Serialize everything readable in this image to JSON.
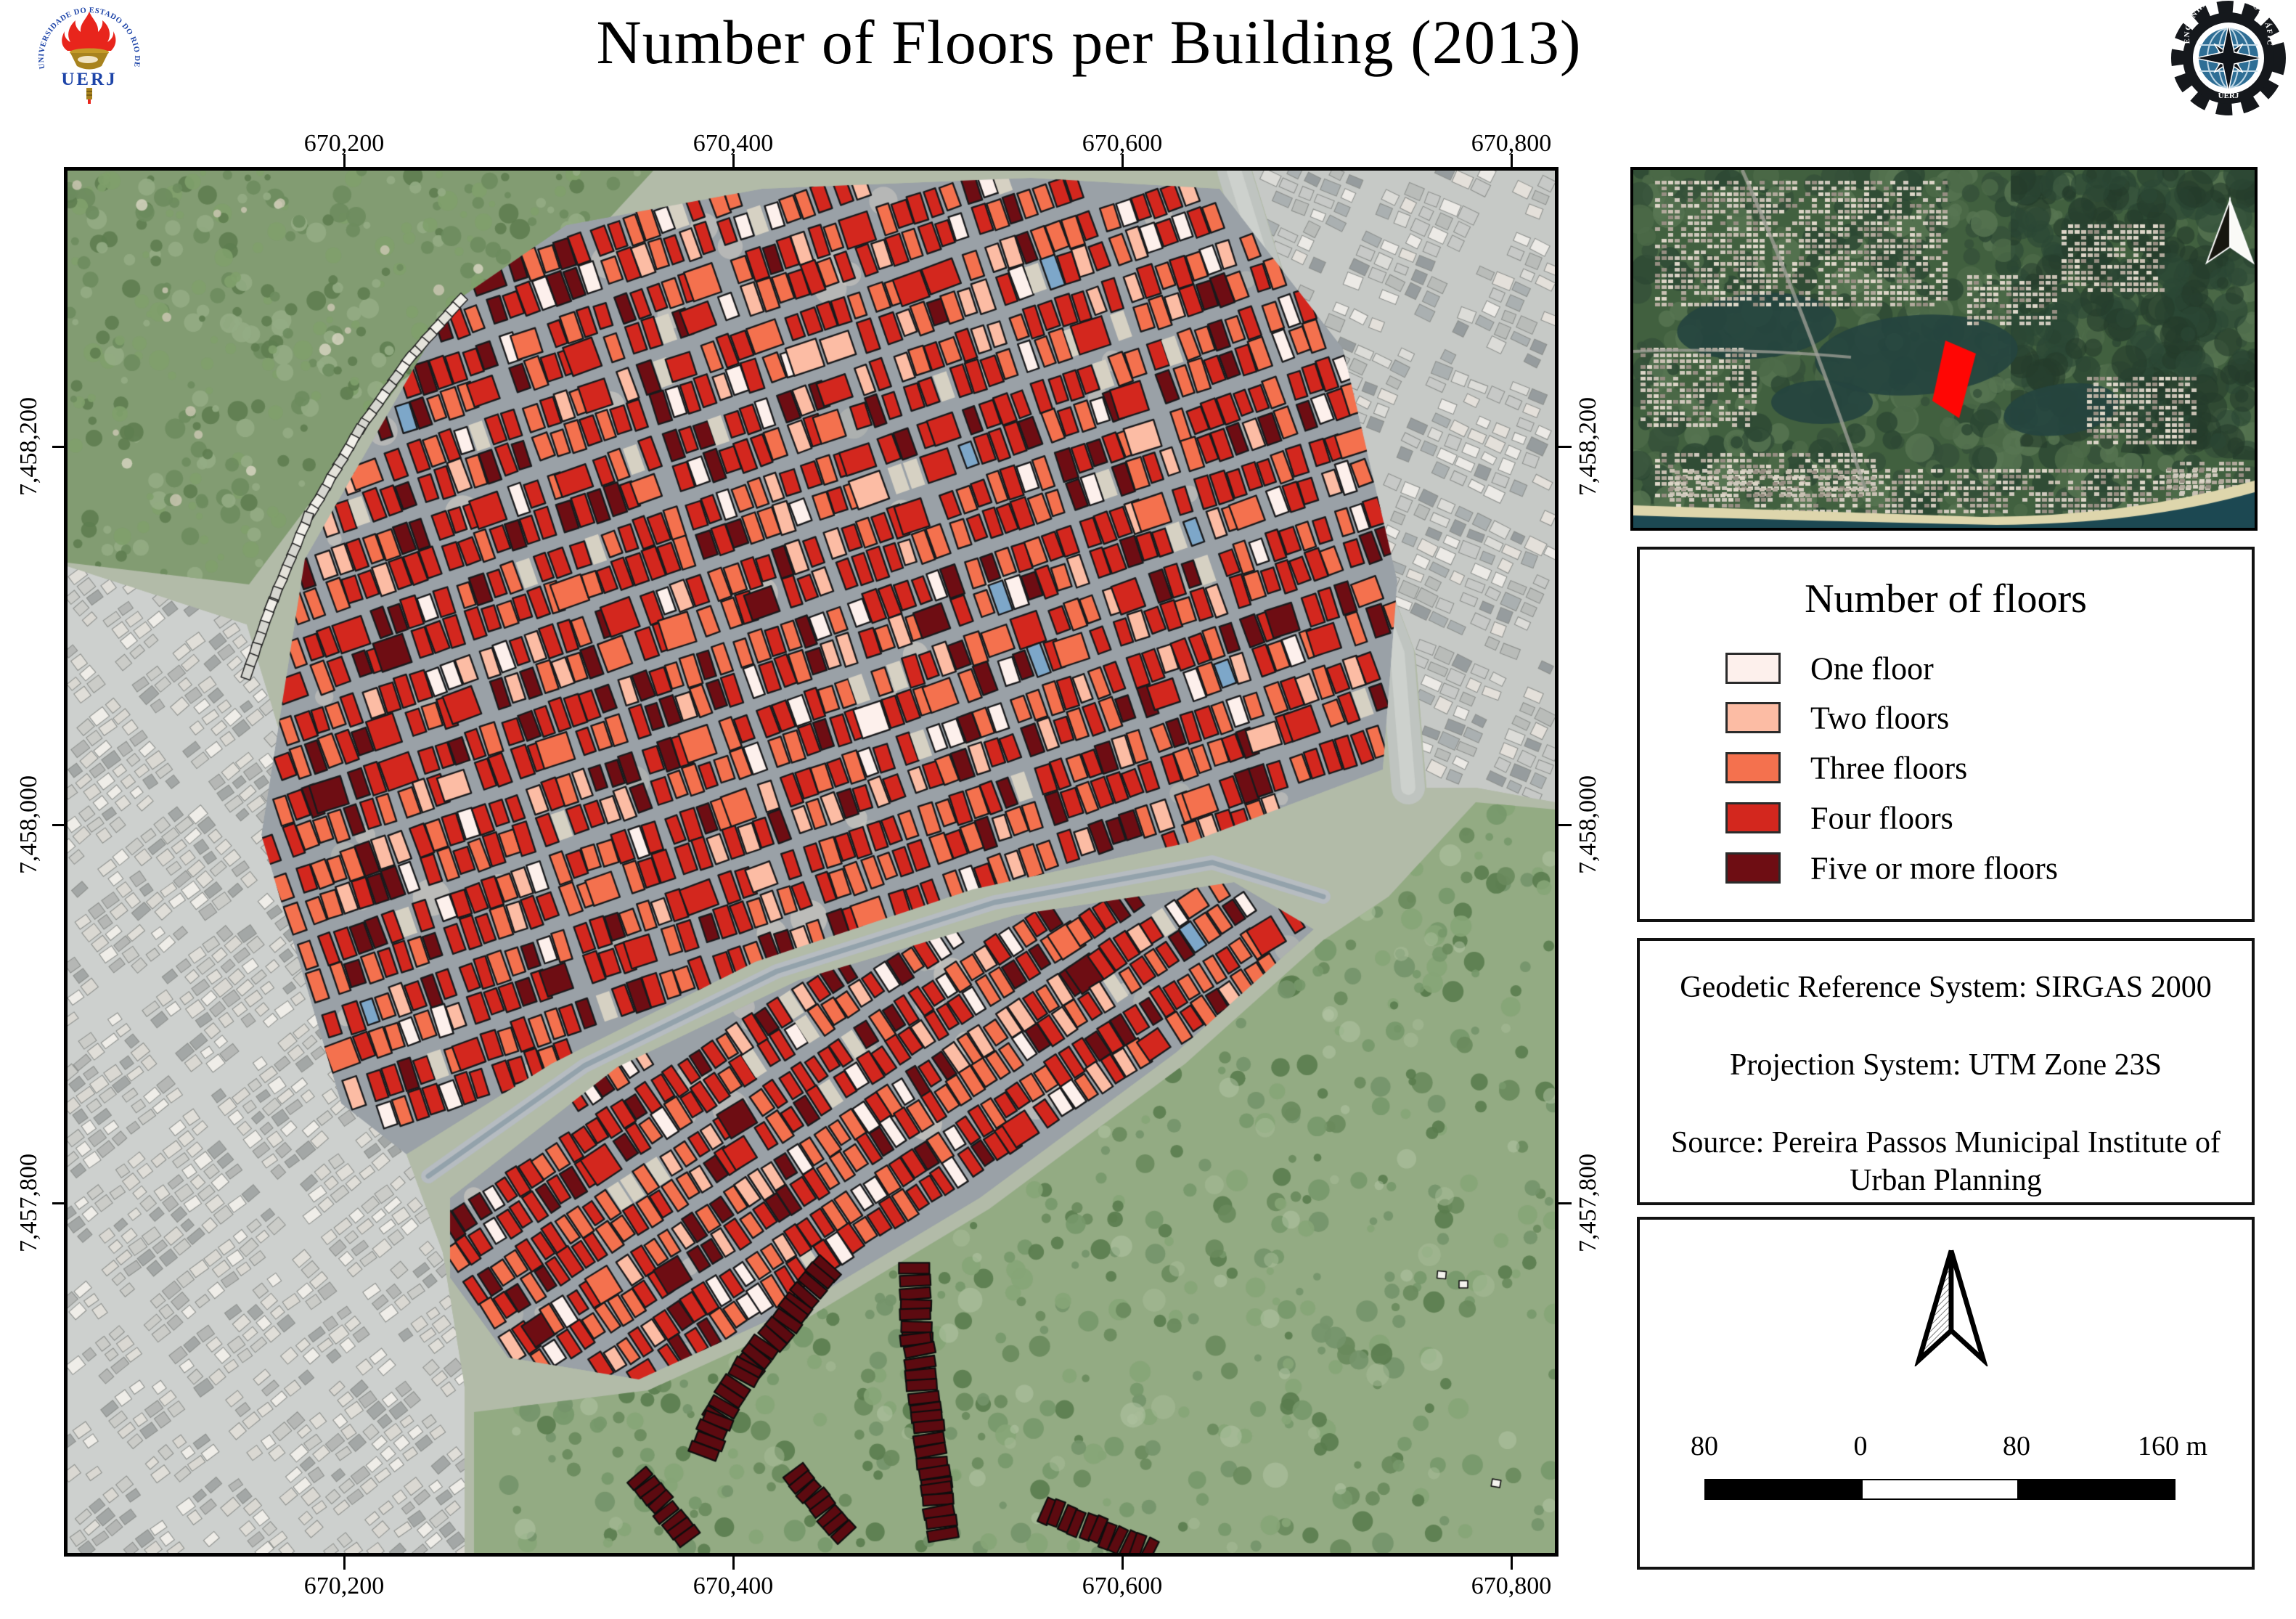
{
  "page": {
    "title": "Number of Floors per Building (2013)"
  },
  "logos": {
    "uerj": {
      "arc_text": "UNIVERSIDADE DO ESTADO DO RIO DE JANEIRO",
      "label": "UERJ"
    },
    "cartography": {
      "arc_text": "ENGENHARIA CARTOGRÁFICA",
      "label": "UERJ"
    }
  },
  "main_map": {
    "x_ticks": [
      "670,200",
      "670,400",
      "670,600",
      "670,800"
    ],
    "y_ticks": [
      "7,458,200",
      "7,458,000",
      "7,457,800"
    ]
  },
  "inset": {
    "marker_color": "#ff0604"
  },
  "legend": {
    "title": "Number of floors",
    "items": [
      {
        "label": "One floor",
        "color": "#fdf0ec"
      },
      {
        "label": "Two floors",
        "color": "#fcbca4"
      },
      {
        "label": "Three floors",
        "color": "#f4714e"
      },
      {
        "label": "Four floors",
        "color": "#d3271e"
      },
      {
        "label": "Five or more floors",
        "color": "#6e0d13"
      }
    ]
  },
  "info_box": {
    "lines": [
      "Geodetic Reference System: SIRGAS 2000",
      "Projection System: UTM Zone 23S",
      "Source: Pereira Passos Municipal Institute of Urban Planning"
    ]
  },
  "scale_bar": {
    "labels": [
      "80",
      "0",
      "80",
      "160 m"
    ]
  },
  "map_style": {
    "street_color": "#9aa1a7",
    "building_outline": "#191a1c",
    "condo_color": "#5c0a10",
    "class_shares": [
      0.07,
      0.1,
      0.25,
      0.44,
      0.135
    ]
  }
}
